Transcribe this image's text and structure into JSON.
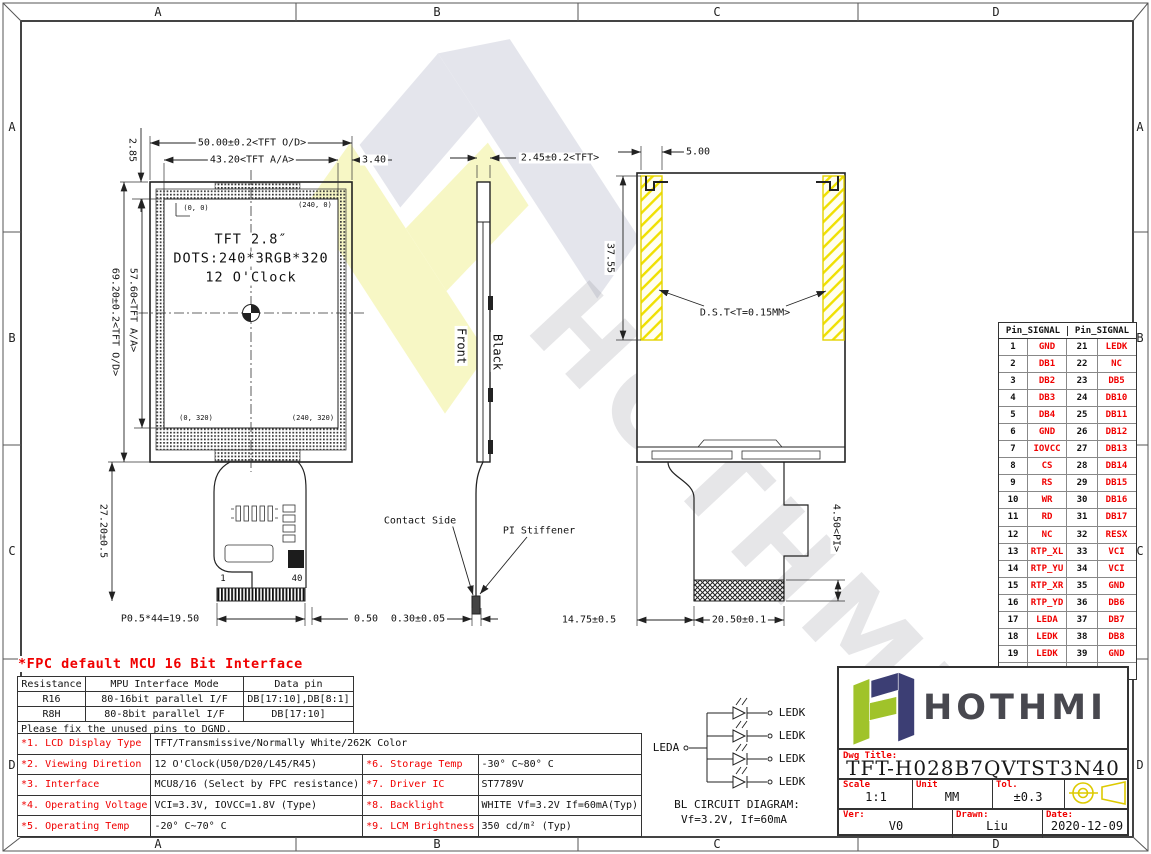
{
  "frame": {
    "cols": [
      "A",
      "B",
      "C",
      "D"
    ],
    "rows": [
      "A",
      "B",
      "C",
      "D"
    ]
  },
  "front_view": {
    "dim_width_od": "50.00±0.2<TFT O/D>",
    "dim_width_aa": "43.20<TFT A/A>",
    "dim_margin_right": "3.40",
    "dim_margin_top": "2.85",
    "dim_height_od": "69.20±0.2<TFT O/D>",
    "dim_height_aa": "57.60<TFT A/A>",
    "corner_tl": "(0, 0)",
    "corner_tr": "(240, 0)",
    "corner_bl": "(0, 320)",
    "corner_br": "(240, 320)",
    "label_line1": "TFT 2.8″",
    "label_line2": "DOTS:240*3RGB*320",
    "label_line3": "12 O'Clock",
    "dim_fpc_drop": "27.20±0.5",
    "pin_first": "1",
    "pin_last": "40",
    "dim_pitch": "P0.5*44=19.50",
    "dim_end": "0.50"
  },
  "side_view": {
    "dim_thickness": "2.45±0.2<TFT>",
    "label_front": "Front",
    "label_black": "Black",
    "label_contact": "Contact Side",
    "label_stiffener": "PI Stiffener",
    "dim_stiffener": "0.30±0.05"
  },
  "back_view": {
    "dim_tape_width": "5.00",
    "dim_tape_height": "37.55",
    "label_tape": "D.S.T<T=0.15MM>",
    "dim_pi": "4.50<PI>",
    "dim_tail": "14.75±0.5",
    "dim_connector": "20.50±0.1"
  },
  "pin_table": {
    "header": "Pin_SIGNAL",
    "rows": [
      [
        "1",
        "GND",
        "21",
        "LEDK"
      ],
      [
        "2",
        "DB1",
        "22",
        "NC"
      ],
      [
        "3",
        "DB2",
        "23",
        "DB5"
      ],
      [
        "4",
        "DB3",
        "24",
        "DB10"
      ],
      [
        "5",
        "DB4",
        "25",
        "DB11"
      ],
      [
        "6",
        "GND",
        "26",
        "DB12"
      ],
      [
        "7",
        "IOVCC",
        "27",
        "DB13"
      ],
      [
        "8",
        "CS",
        "28",
        "DB14"
      ],
      [
        "9",
        "RS",
        "29",
        "DB15"
      ],
      [
        "10",
        "WR",
        "30",
        "DB16"
      ],
      [
        "11",
        "RD",
        "31",
        "DB17"
      ],
      [
        "12",
        "NC",
        "32",
        "RESX"
      ],
      [
        "13",
        "RTP_XL",
        "33",
        "VCI"
      ],
      [
        "14",
        "RTP_YU",
        "34",
        "VCI"
      ],
      [
        "15",
        "RTP_XR",
        "35",
        "GND"
      ],
      [
        "16",
        "RTP_YD",
        "36",
        "DB6"
      ],
      [
        "17",
        "LEDA",
        "37",
        "DB7"
      ],
      [
        "18",
        "LEDK",
        "38",
        "DB8"
      ],
      [
        "19",
        "LEDK",
        "39",
        "GND"
      ],
      [
        "20",
        "LEDK",
        "40",
        "GND"
      ]
    ]
  },
  "fpc_block": {
    "title": "*FPC default MCU 16 Bit Interface",
    "headers": [
      "Resistance",
      "MPU Interface Mode",
      "Data pin"
    ],
    "rows": [
      [
        "R16",
        "80-16bit parallel I/F",
        "DB[17:10],DB[8:1]"
      ],
      [
        "R8H",
        "80-8bit parallel I/F",
        "DB[17:10]"
      ]
    ],
    "note": "Please fix the unused pins to DGND."
  },
  "spec_table": {
    "items": [
      {
        "k": "*1. LCD Display Type",
        "v": "TFT/Transmissive/Normally White/262K Color"
      },
      {
        "k": "*2. Viewing Diretion",
        "v": "12 O'Clock(U50/D20/L45/R45)"
      },
      {
        "k": "*3. Interface",
        "v": "MCU8/16 (Select by FPC resistance)"
      },
      {
        "k": "*4. Operating Voltage",
        "v": "VCI=3.3V, IOVCC=1.8V (Type)"
      },
      {
        "k": "*5. Operating Temp",
        "v": "-20° C~70° C"
      },
      {
        "k": "*6. Storage Temp",
        "v": "-30° C~80° C"
      },
      {
        "k": "*7. Driver IC",
        "v": "ST7789V"
      },
      {
        "k": "*8. Backlight",
        "v": "WHITE Vf=3.2V If=60mA(Typ)"
      },
      {
        "k": "*9. LCM Brightness",
        "v": "350 cd/m² (Typ)"
      }
    ]
  },
  "bl_circuit": {
    "label_anode": "LEDA",
    "label_cathode": "LEDK",
    "caption1": "BL CIRCUIT DIAGRAM:",
    "caption2": "Vf=3.2V, If=60mA"
  },
  "title_block": {
    "brand": "HOTHMI",
    "dwg_title_label": "Dwg Title:",
    "dwg_title": "TFT-H028B7QVTST3N40",
    "scale_label": "Scale",
    "scale": "1:1",
    "unit_label": "Unit",
    "unit": "MM",
    "tol_label": "Tol.",
    "tol": "±0.3",
    "ver_label": "Ver:",
    "ver": "V0",
    "drawn_label": "Drawn:",
    "drawn": "Liu",
    "date_label": "Date:",
    "date": "2020-12-09"
  },
  "colors": {
    "accent_red": "#f00000",
    "tape_yellow": "#f0e000",
    "logo_green": "#a0c32a",
    "logo_navy": "#3c3e74"
  }
}
